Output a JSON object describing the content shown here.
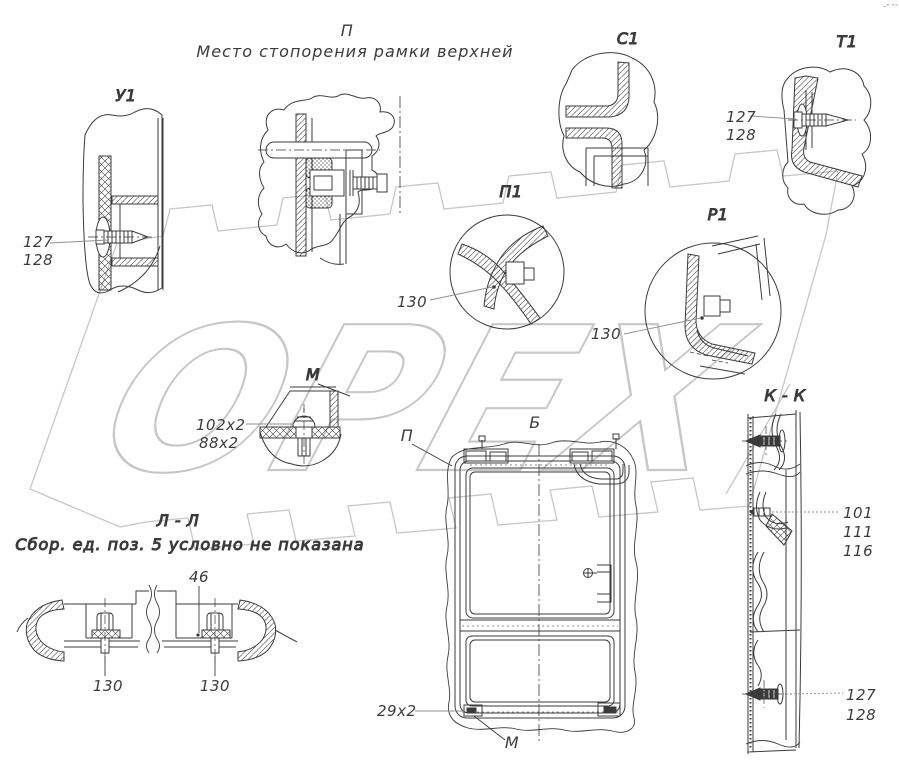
{
  "header": {
    "view_letter": "П",
    "caption": "Место стопорения рамки верхней"
  },
  "watermark": {
    "text": "ОРЕХ",
    "color": "#c7c7c7"
  },
  "colors": {
    "background": "#ffffff",
    "line": "#3b3b3b",
    "leader": "#8f8f8f",
    "watermark": "#c7c7c7"
  },
  "views": {
    "u1": {
      "label": "У1",
      "callouts": {
        "c127": "127",
        "c128": "128"
      }
    },
    "c1": {
      "label": "С1"
    },
    "t1": {
      "label": "Т1",
      "callouts": {
        "c127": "127",
        "c128": "128"
      }
    },
    "p1": {
      "label": "П1",
      "callouts": {
        "c130": "130"
      }
    },
    "r1": {
      "label": "Р1",
      "callouts": {
        "c130": "130"
      }
    },
    "m": {
      "label": "М",
      "callouts": {
        "c102": "102x2",
        "c88": "88x2"
      }
    },
    "ll": {
      "label": "Л - Л",
      "note": "Сбор. ед. поз. 5 условно не показана",
      "callouts": {
        "c46": "46",
        "c130_left": "130",
        "c130_right": "130"
      }
    },
    "b": {
      "label": "Б",
      "refs": {
        "p": "П",
        "m": "М"
      },
      "callouts": {
        "c29": "29x2"
      }
    },
    "kk": {
      "label": "К - К",
      "callouts": {
        "c101": "101",
        "c111": "111",
        "c116": "116",
        "c127": "127",
        "c128": "128"
      }
    }
  }
}
